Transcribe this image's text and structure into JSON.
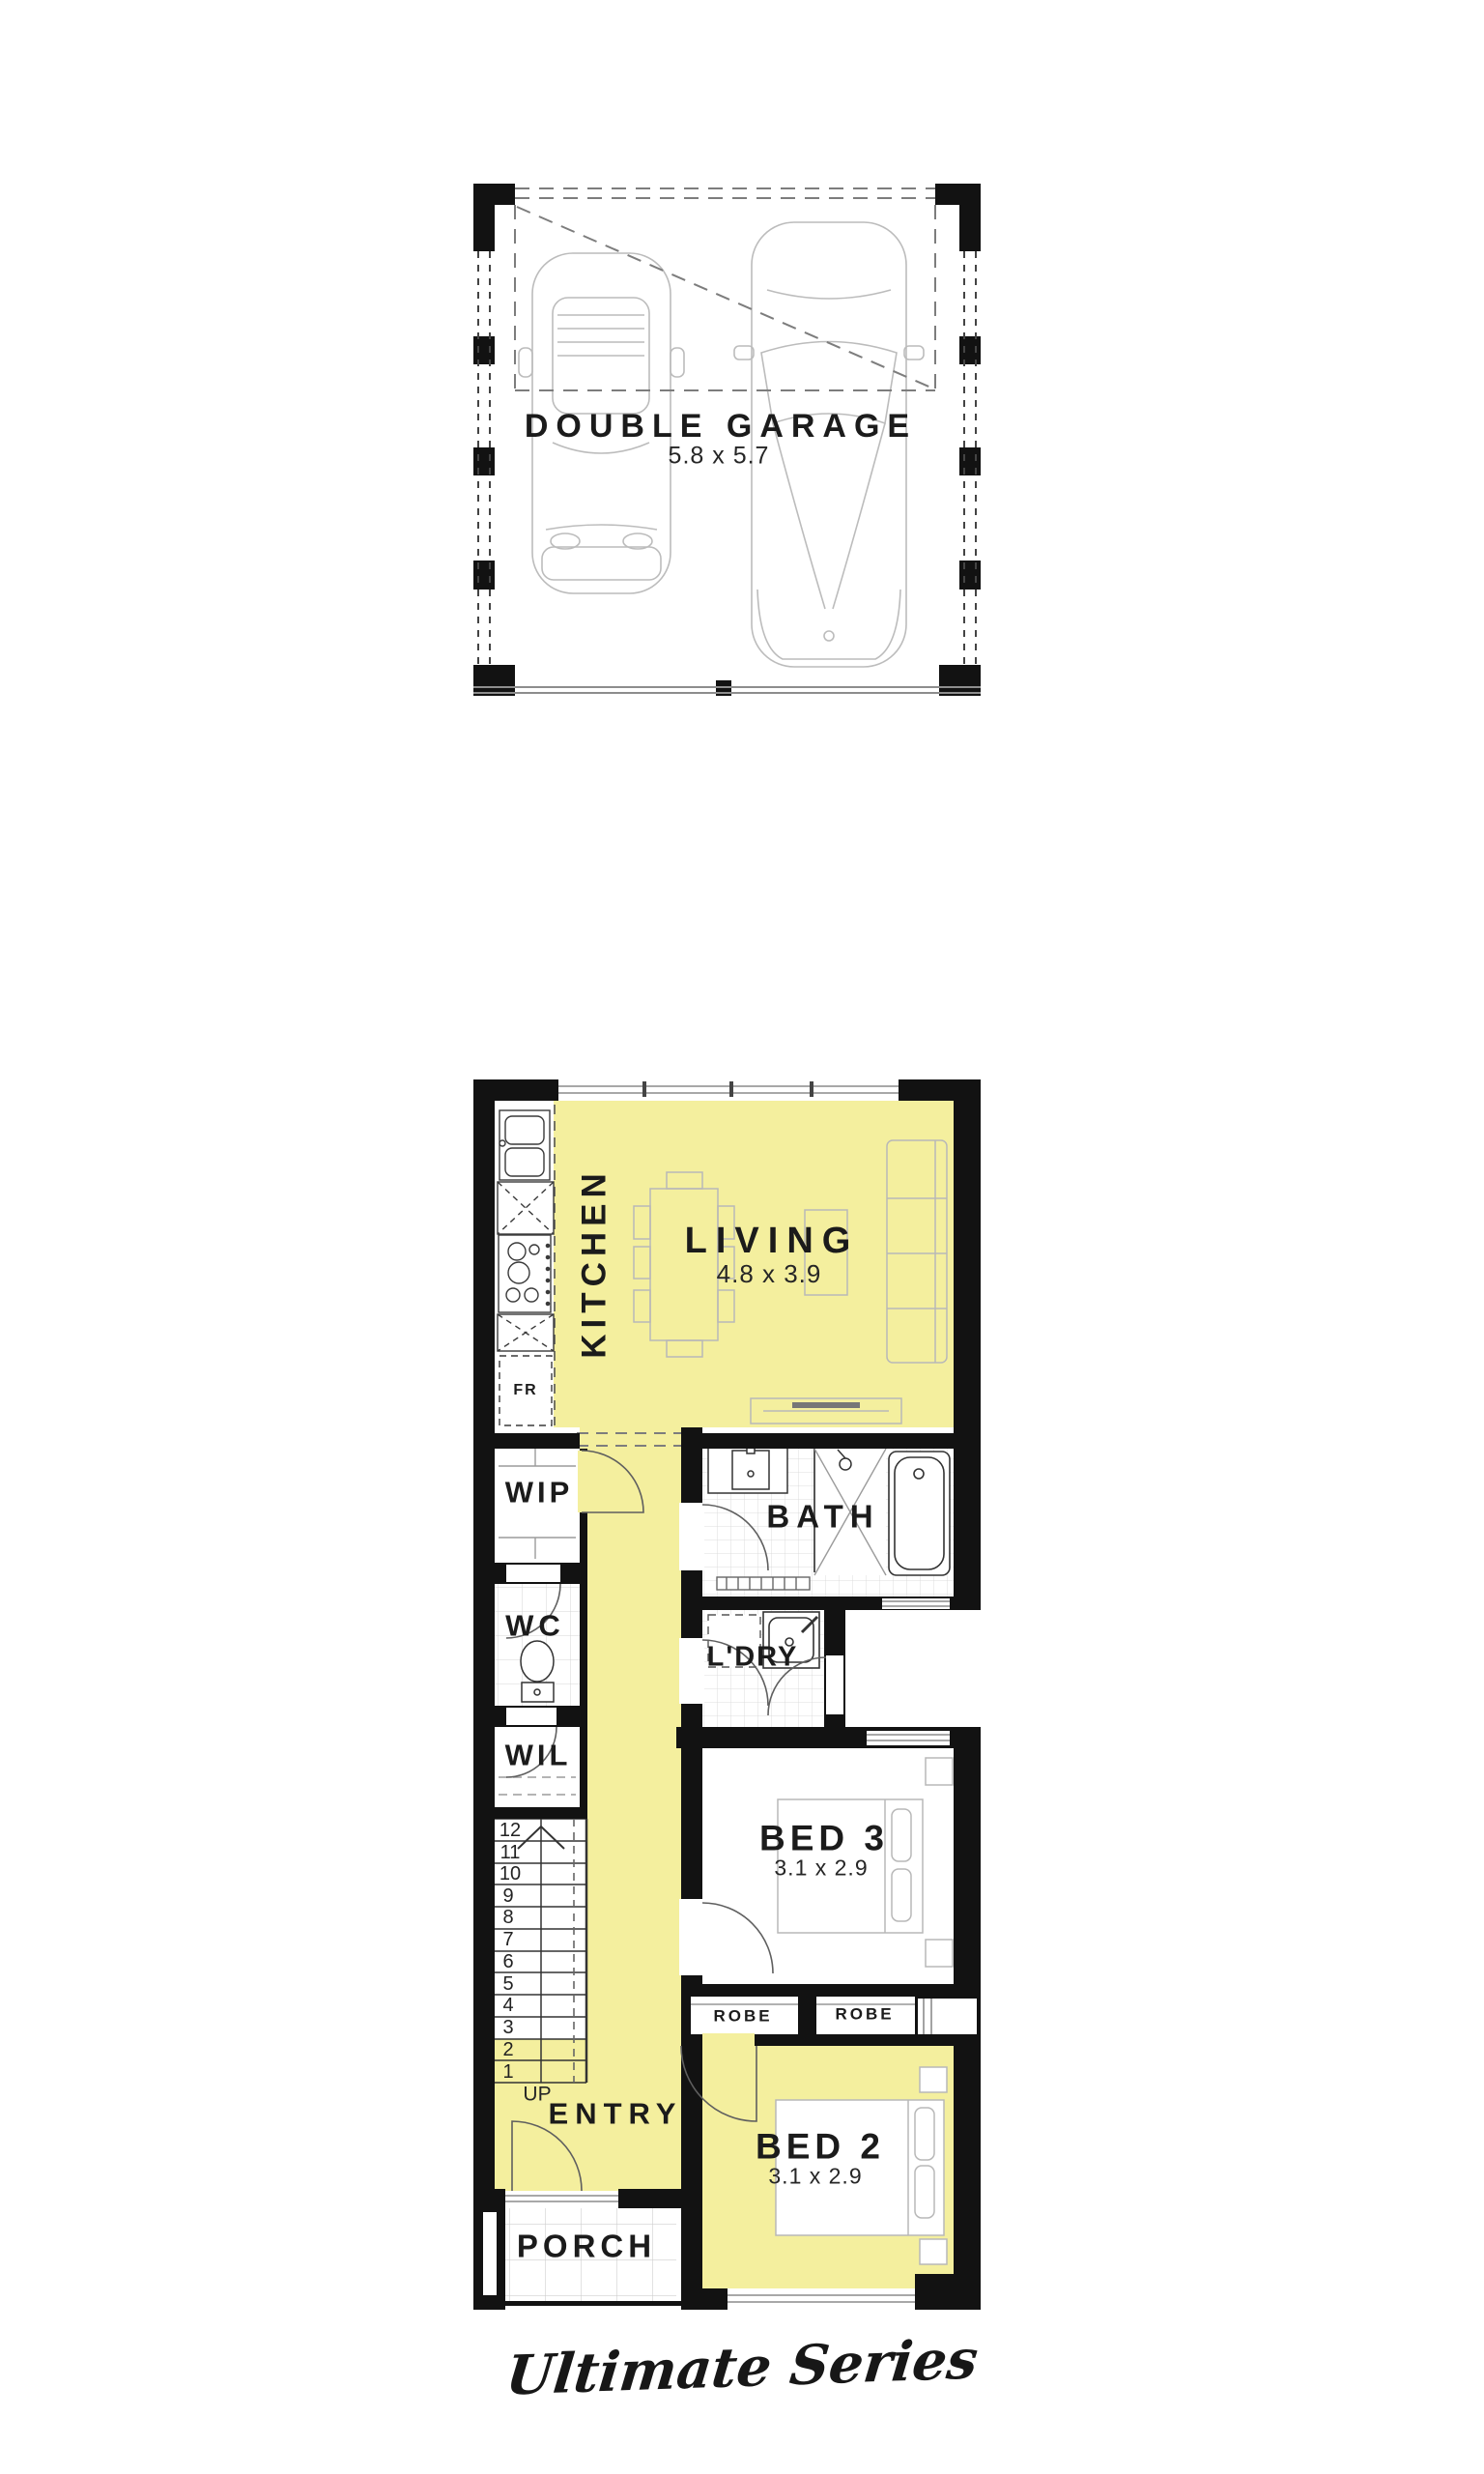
{
  "plan": {
    "series_label": "Ultimate Series",
    "garage": {
      "title": "DOUBLE GARAGE",
      "size": "5.8 x 5.7"
    },
    "rooms": {
      "living": {
        "label": "LIVING",
        "size": "4.8 x 3.9"
      },
      "kitchen": {
        "label": "KITCHEN"
      },
      "fridge_label": "FR",
      "wip": {
        "label": "WIP"
      },
      "wc": {
        "label": "WC"
      },
      "wil": {
        "label": "WIL"
      },
      "bath": {
        "label": "BATH"
      },
      "laundry": {
        "label": "L'DRY"
      },
      "bed3": {
        "label": "BED 3",
        "size": "3.1 x 2.9"
      },
      "bed2": {
        "label": "BED 2",
        "size": "3.1 x 2.9"
      },
      "robe_left": "ROBE",
      "robe_right": "ROBE",
      "entry": {
        "label": "ENTRY"
      },
      "porch": {
        "label": "PORCH"
      }
    },
    "stairs": {
      "up": "UP",
      "steps": [
        "12",
        "11",
        "10",
        "9",
        "8",
        "7",
        "6",
        "5",
        "4",
        "3",
        "2",
        "1"
      ]
    }
  },
  "colors": {
    "highlight": "#F4EF9E",
    "wall": "#121212",
    "fixture_line": "#9b9b9b",
    "furniture_line": "#b8b8b8"
  }
}
